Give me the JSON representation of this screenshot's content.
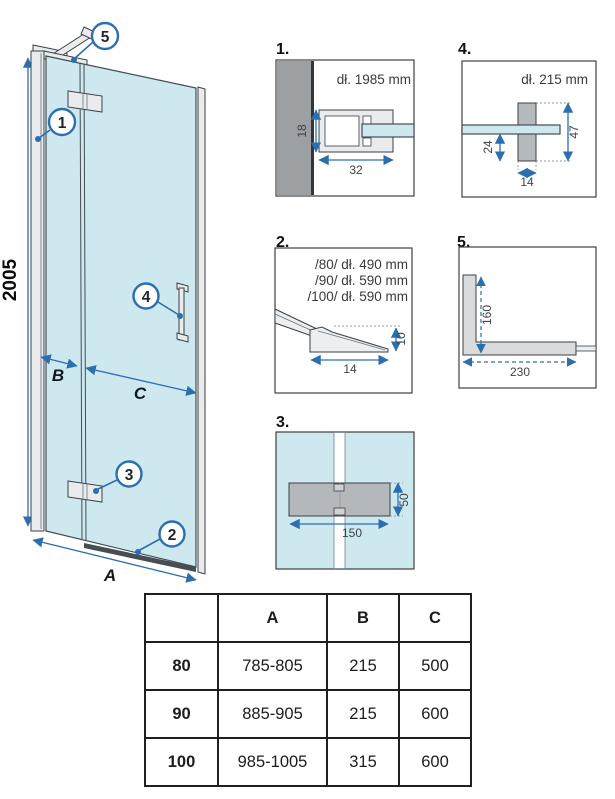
{
  "main_diagram": {
    "height_dim": "2005",
    "width_dim": "A",
    "fixed_dim": "B",
    "door_dim": "C",
    "callouts": {
      "c1": "1",
      "c2": "2",
      "c3": "3",
      "c4": "4",
      "c5": "5"
    }
  },
  "details": {
    "d1": {
      "label": "1.",
      "title": "dł. 1985 mm",
      "dim_height": "18",
      "dim_width": "32"
    },
    "d4": {
      "label": "4.",
      "title": "dł. 215 mm",
      "dim_offset": "24",
      "dim_height": "47",
      "dim_width": "14"
    },
    "d2": {
      "label": "2.",
      "sizes": [
        "/80/ dł. 490 mm",
        "/90/ dł. 590 mm",
        "/100/ dł. 590 mm"
      ],
      "dim_height": "10",
      "dim_width": "14"
    },
    "d5": {
      "label": "5.",
      "dim_vertical": "160",
      "dim_horizontal": "230"
    },
    "d3": {
      "label": "3.",
      "dim_width": "150",
      "dim_height": "50"
    }
  },
  "table": {
    "headers": [
      "",
      "A",
      "B",
      "C"
    ],
    "rows": [
      [
        "80",
        "785-805",
        "215",
        "500"
      ],
      [
        "90",
        "885-905",
        "215",
        "600"
      ],
      [
        "100",
        "985-1005",
        "315",
        "600"
      ]
    ]
  },
  "colors": {
    "glass": "#cde8ef",
    "accent_blue": "#2b6fb0",
    "wall_gray": "#9ca0a3",
    "profile_gray": "#e9ebec",
    "hinge_gray": "#b5b8bb",
    "outline": "#3a4046"
  }
}
